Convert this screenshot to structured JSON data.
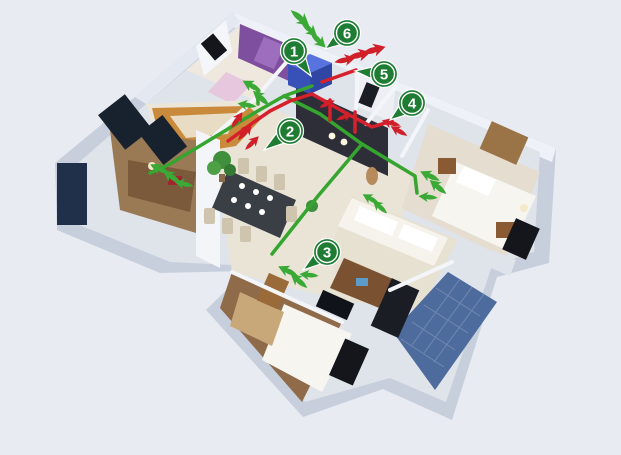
{
  "scene": {
    "title": "home-ventilation-isometric-floorplan",
    "width": 621,
    "height": 455,
    "background": "#e8ebf1"
  },
  "palette": {
    "pin_green": "#1e7c33",
    "pin_ring": "#ffffff",
    "supply_green": "#3aa935",
    "exhaust_red": "#d01f28",
    "duct_supply": "#35a52f",
    "duct_exhaust": "#d6202c",
    "unit_blue": "#4260cc",
    "wall_side": "#c7cfdc",
    "wall_top": "#eef1f7",
    "floor_cream": "#e9e4d6",
    "floor_wood": "#8f6b4a",
    "dark_wall": "#2e2e38",
    "balcony_tile": "#4d6b9d",
    "purple_wall": "#7d4f9e",
    "kitchen_wood": "#c98a3b"
  },
  "markers": [
    {
      "label": "1",
      "cx": 294,
      "cy": 51,
      "tipX": 311,
      "tipY": 76
    },
    {
      "label": "2",
      "cx": 290,
      "cy": 131,
      "tipX": 264,
      "tipY": 150
    },
    {
      "label": "3",
      "cx": 327,
      "cy": 252,
      "tipX": 303,
      "tipY": 270
    },
    {
      "label": "4",
      "cx": 412,
      "cy": 103,
      "tipX": 390,
      "tipY": 120
    },
    {
      "label": "5",
      "cx": 384,
      "cy": 74,
      "tipX": 355,
      "tipY": 71
    },
    {
      "label": "6",
      "cx": 347,
      "cy": 33,
      "tipX": 325,
      "tipY": 49
    }
  ],
  "arrows": [
    {
      "type": "supply",
      "x": 300,
      "y": 18,
      "angle": 40,
      "s": 1.0
    },
    {
      "type": "supply",
      "x": 309,
      "y": 29,
      "angle": 42,
      "s": 0.9
    },
    {
      "type": "supply",
      "x": 318,
      "y": 40,
      "angle": 45,
      "s": 0.9
    },
    {
      "type": "exhaust",
      "x": 345,
      "y": 60,
      "angle": -12,
      "s": 0.9
    },
    {
      "type": "exhaust",
      "x": 359,
      "y": 55,
      "angle": -14,
      "s": 1.0
    },
    {
      "type": "exhaust",
      "x": 374,
      "y": 50,
      "angle": -16,
      "s": 1.0
    },
    {
      "type": "supply",
      "x": 252,
      "y": 86,
      "angle": 210,
      "s": 0.9
    },
    {
      "type": "supply",
      "x": 261,
      "y": 98,
      "angle": 222,
      "s": 0.9
    },
    {
      "type": "supply",
      "x": 247,
      "y": 105,
      "angle": 190,
      "s": 0.8
    },
    {
      "type": "exhaust",
      "x": 237,
      "y": 120,
      "angle": -55,
      "s": 0.8
    },
    {
      "type": "exhaust",
      "x": 245,
      "y": 132,
      "angle": -50,
      "s": 0.9
    },
    {
      "type": "exhaust",
      "x": 252,
      "y": 143,
      "angle": -45,
      "s": 0.8
    },
    {
      "type": "exhaust",
      "x": 327,
      "y": 104,
      "angle": -25,
      "s": 0.7
    },
    {
      "type": "exhaust",
      "x": 344,
      "y": 117,
      "angle": -20,
      "s": 0.7
    },
    {
      "type": "exhaust",
      "x": 391,
      "y": 123,
      "angle": 195,
      "s": 0.8
    },
    {
      "type": "exhaust",
      "x": 399,
      "y": 131,
      "angle": 210,
      "s": 0.8
    },
    {
      "type": "supply",
      "x": 160,
      "y": 169,
      "angle": 205,
      "s": 0.9
    },
    {
      "type": "supply",
      "x": 172,
      "y": 177,
      "angle": 215,
      "s": 0.9
    },
    {
      "type": "supply",
      "x": 184,
      "y": 184,
      "angle": 192,
      "s": 0.8
    },
    {
      "type": "supply",
      "x": 430,
      "y": 176,
      "angle": 205,
      "s": 0.9
    },
    {
      "type": "supply",
      "x": 438,
      "y": 187,
      "angle": 220,
      "s": 0.9
    },
    {
      "type": "supply",
      "x": 428,
      "y": 197,
      "angle": 185,
      "s": 0.8
    },
    {
      "type": "supply",
      "x": 371,
      "y": 199,
      "angle": 210,
      "s": 0.8
    },
    {
      "type": "supply",
      "x": 380,
      "y": 207,
      "angle": 222,
      "s": 0.8
    },
    {
      "type": "supply",
      "x": 288,
      "y": 271,
      "angle": 205,
      "s": 0.9
    },
    {
      "type": "supply",
      "x": 299,
      "y": 281,
      "angle": 220,
      "s": 0.9
    },
    {
      "type": "supply",
      "x": 309,
      "y": 275,
      "angle": 185,
      "s": 0.8
    }
  ],
  "ducts": [
    {
      "type": "supply",
      "points": [
        [
          312,
          86
        ],
        [
          284,
          96
        ],
        [
          256,
          112
        ],
        [
          170,
          164
        ],
        [
          150,
          173
        ]
      ]
    },
    {
      "type": "supply",
      "points": [
        [
          284,
          96
        ],
        [
          320,
          114
        ],
        [
          362,
          144
        ],
        [
          415,
          176
        ],
        [
          417,
          193
        ]
      ]
    },
    {
      "type": "supply",
      "points": [
        [
          362,
          144
        ],
        [
          318,
          196
        ],
        [
          272,
          254
        ]
      ]
    },
    {
      "type": "supply",
      "points": [
        [
          258,
          90
        ],
        [
          258,
          104
        ]
      ]
    },
    {
      "type": "exhaust",
      "points": [
        [
          228,
          141
        ],
        [
          254,
          122
        ],
        [
          270,
          111
        ],
        [
          290,
          101
        ],
        [
          312,
          94
        ]
      ]
    },
    {
      "type": "exhaust",
      "points": [
        [
          322,
          82
        ],
        [
          342,
          75
        ],
        [
          356,
          70
        ]
      ]
    },
    {
      "type": "exhaust",
      "points": [
        [
          312,
          94
        ],
        [
          344,
          112
        ],
        [
          372,
          127
        ],
        [
          392,
          121
        ]
      ]
    },
    {
      "type": "exhaust",
      "points": [
        [
          330,
          100
        ],
        [
          330,
          120
        ]
      ]
    },
    {
      "type": "exhaust",
      "points": [
        [
          355,
          112
        ],
        [
          355,
          132
        ]
      ]
    }
  ],
  "unit": {
    "name": "hrv-ventilation-unit",
    "x": 288,
    "y": 62
  }
}
